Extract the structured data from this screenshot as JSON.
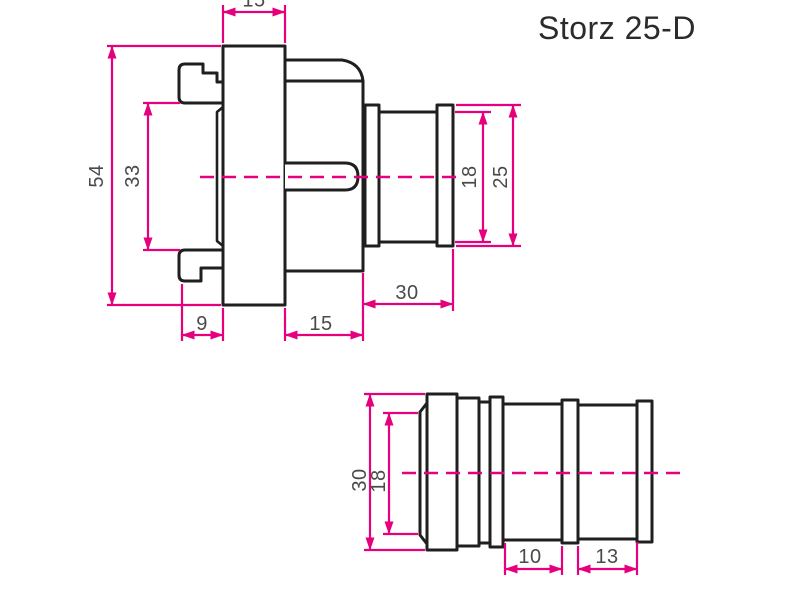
{
  "title": "Storz 25-D",
  "colors": {
    "outline": "#1f1f1f",
    "dimension": "#e6007e",
    "label": "#4a4a4a",
    "background": "#ffffff"
  },
  "coupling_view": {
    "description": "Storz coupling cross-section with claws and hose tail",
    "dimensions": {
      "flange_width": "15",
      "coupling_diameter": "54",
      "claw_clearance": "33",
      "tail_bore": "18",
      "tail_outer": "25",
      "tail_length": "30",
      "claw_depth": "9",
      "body_length": "15"
    }
  },
  "nipple_view": {
    "description": "Hose nipple side view with barb rings",
    "dimensions": {
      "outer_diameter": "30",
      "bore_diameter": "18",
      "barb_pitch_a": "10",
      "barb_pitch_b": "13"
    }
  }
}
